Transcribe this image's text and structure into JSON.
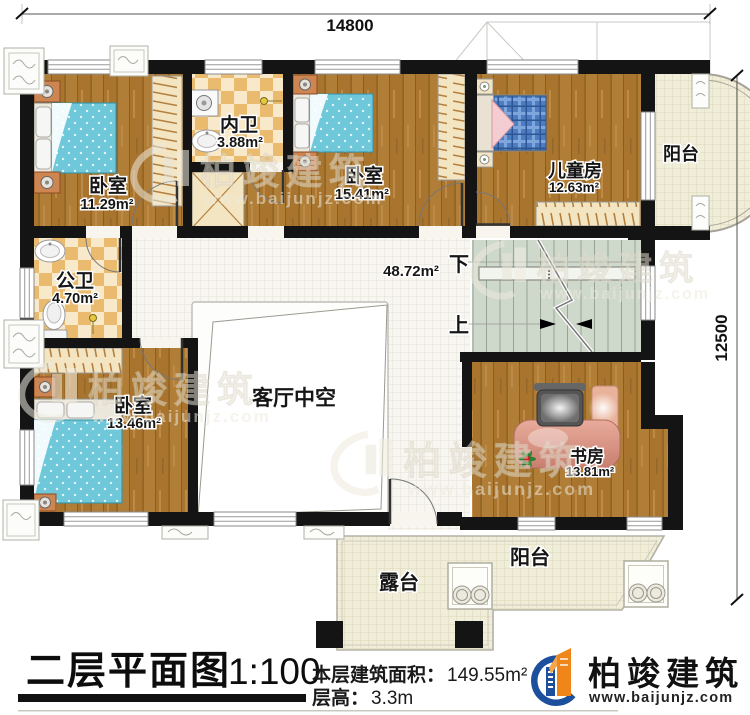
{
  "dimensions": {
    "width_label": "14800",
    "height_label": "12500"
  },
  "rooms": {
    "bedroom1": {
      "name": "卧室",
      "area": "11.29m²"
    },
    "inner_bath": {
      "name": "内卫",
      "area": "3.88m²"
    },
    "bedroom2": {
      "name": "卧室",
      "area": "15.41m²"
    },
    "kids_room": {
      "name": "儿童房",
      "area": "12.63m²"
    },
    "balcony_top": {
      "name": "阳台"
    },
    "public_bath": {
      "name": "公卫",
      "area": "4.70m²"
    },
    "bedroom3": {
      "name": "卧室",
      "area": "13.46m²"
    },
    "living_void": {
      "name": "客厅中空"
    },
    "hall": {
      "area": "48.72m²"
    },
    "stairs": {
      "down": "下",
      "up": "上"
    },
    "study": {
      "name": "书房",
      "area": "13.81m²"
    },
    "balcony_bottom": {
      "name": "阳台"
    },
    "terrace": {
      "name": "露台"
    }
  },
  "footer": {
    "title": "二层平面图",
    "scale": "1:100",
    "area_label": "本层建筑面积：",
    "area_value": "149.55m²",
    "height_label": "层高：",
    "height_value": "3.3m"
  },
  "brand": {
    "name": "柏竣建筑",
    "website": "www.baijunjz.com"
  },
  "watermark": {
    "name": "柏竣建筑",
    "website": "www.baijunjz.com"
  },
  "colors": {
    "wall": "#141414",
    "wood": "#b07c35",
    "tile": "#eaba6e",
    "stairs": "#ced8cb",
    "outdoor": "#f0edd9",
    "bed": "#6fc7da",
    "brand_blue": "#1c4f9c",
    "brand_orange": "#f08519"
  }
}
